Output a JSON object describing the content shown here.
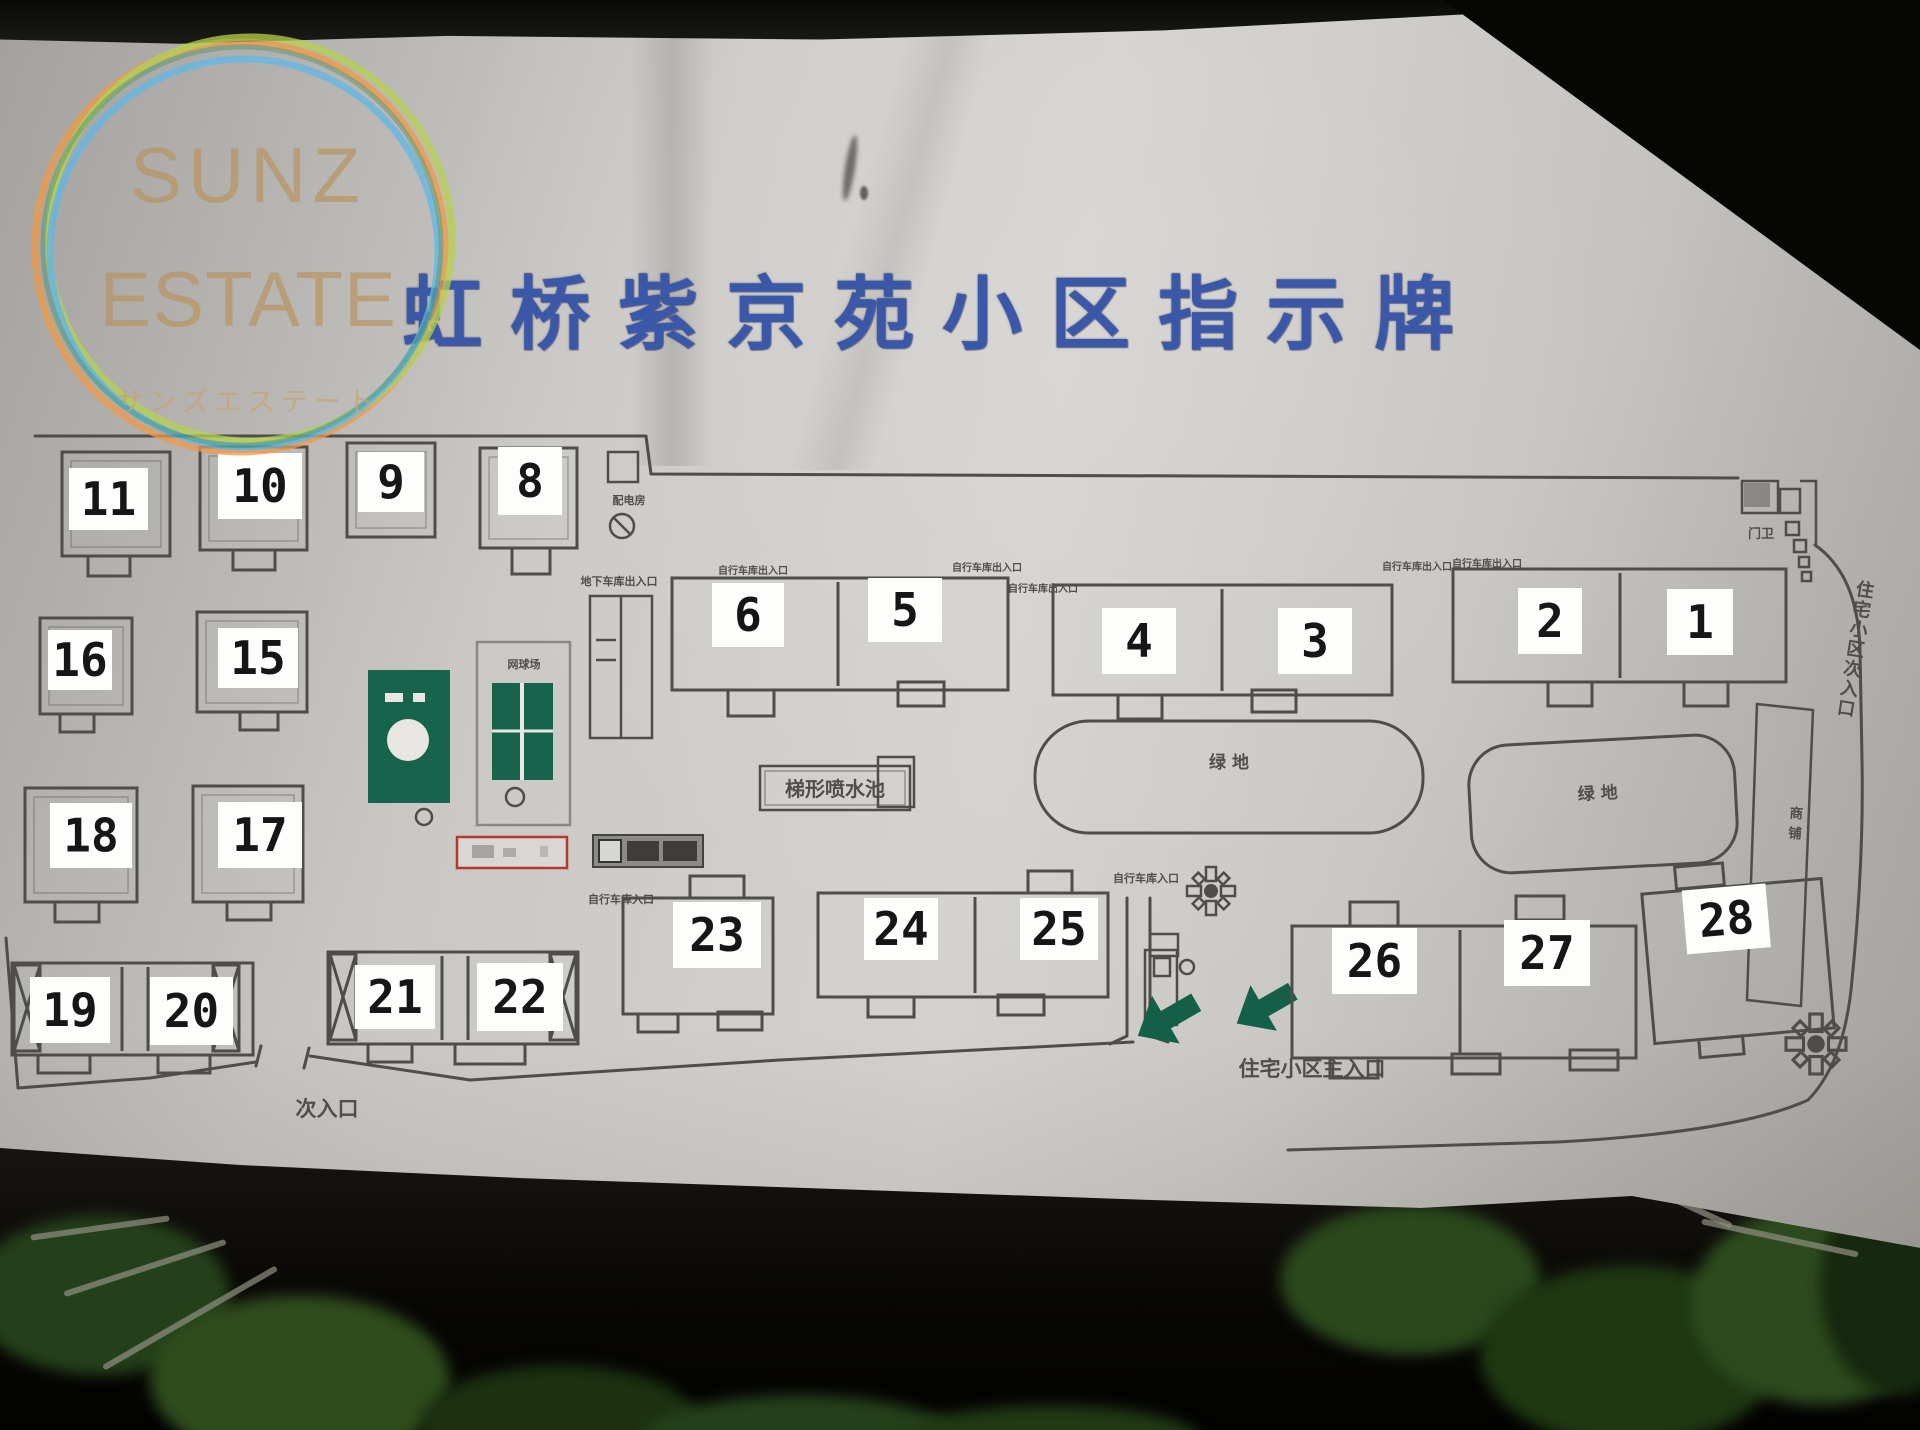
{
  "watermark": {
    "line1": "SUNZ",
    "line2": "ESTATE",
    "line3": "サンズエステート"
  },
  "sign_title": "虹桥紫京苑小区指示牌",
  "colors": {
    "title_blue": "#3a57a8",
    "map_line": "#4f4d49",
    "structure_green": "#17634b",
    "arrow_green": "#155e47",
    "you_are_here_red": "#b23b2d",
    "watermark_tan": "#b99562",
    "ring_orange": "#f09a46",
    "ring_lime": "#b6d24c",
    "ring_blue": "#5fb7e6"
  },
  "map": {
    "side_text": "住宅小区次入口",
    "shop_text": "商铺",
    "buildings": [
      {
        "n": "11",
        "o": [
          62,
          452,
          108,
          104
        ],
        "l": [
          69,
          468,
          79,
          62
        ],
        "s": [
          [
            88,
            556,
            42,
            20
          ]
        ],
        "inner": true
      },
      {
        "n": "10",
        "o": [
          200,
          447,
          107,
          103
        ],
        "l": [
          218,
          453,
          84,
          66
        ],
        "s": [
          [
            233,
            550,
            42,
            20
          ]
        ],
        "inner": true
      },
      {
        "n": "9",
        "o": [
          347,
          443,
          88,
          94
        ],
        "l": [
          358,
          452,
          66,
          60
        ],
        "inner": true
      },
      {
        "n": "8",
        "o": [
          480,
          448,
          97,
          100
        ],
        "l": [
          498,
          447,
          64,
          68
        ],
        "s": [
          [
            512,
            548,
            38,
            26
          ]
        ],
        "inner": true
      },
      {
        "n": "16",
        "o": [
          40,
          618,
          92,
          96
        ],
        "l": [
          48,
          630,
          64,
          60
        ],
        "s": [
          [
            60,
            714,
            34,
            18
          ]
        ],
        "inner": true
      },
      {
        "n": "15",
        "o": [
          197,
          612,
          110,
          100
        ],
        "l": [
          218,
          628,
          80,
          60
        ],
        "s": [
          [
            240,
            712,
            38,
            18
          ]
        ],
        "inner": true
      },
      {
        "n": "18",
        "o": [
          25,
          788,
          112,
          114
        ],
        "l": [
          50,
          803,
          82,
          65
        ],
        "s": [
          [
            55,
            902,
            44,
            20
          ]
        ],
        "inner": true
      },
      {
        "n": "17",
        "o": [
          193,
          786,
          110,
          116
        ],
        "l": [
          218,
          802,
          84,
          66
        ],
        "s": [
          [
            227,
            902,
            44,
            18
          ]
        ],
        "inner": true
      },
      {
        "n": "19",
        "o": [
          12,
          963,
          241,
          92
        ],
        "l": [
          30,
          977,
          80,
          66
        ],
        "s": [
          [
            38,
            1055,
            52,
            18
          ],
          [
            158,
            1055,
            52,
            18
          ]
        ],
        "d": [
          122,
          148
        ],
        "hatch": [
          [
            14,
            965,
            26,
            86
          ],
          [
            213,
            965,
            26,
            86
          ]
        ]
      },
      {
        "n": "20",
        "o": null,
        "l": [
          150,
          977,
          83,
          68
        ]
      },
      {
        "n": "21",
        "o": [
          328,
          952,
          250,
          92
        ],
        "l": [
          355,
          965,
          80,
          64
        ],
        "s": [
          [
            368,
            1044,
            44,
            18
          ],
          [
            455,
            1044,
            70,
            20
          ]
        ],
        "d": [
          442,
          468
        ],
        "hatch": [
          [
            330,
            954,
            26,
            86
          ],
          [
            550,
            954,
            26,
            86
          ]
        ]
      },
      {
        "n": "22",
        "o": null,
        "l": [
          477,
          963,
          86,
          68
        ]
      },
      {
        "n": "6",
        "o": [
          672,
          578,
          336,
          112
        ],
        "l": [
          712,
          583,
          72,
          64
        ],
        "s": [
          [
            728,
            690,
            46,
            26
          ],
          [
            898,
            682,
            46,
            24
          ]
        ],
        "d": [
          838
        ]
      },
      {
        "n": "5",
        "o": null,
        "l": [
          868,
          578,
          74,
          64
        ]
      },
      {
        "n": "4",
        "o": [
          1053,
          585,
          339,
          110
        ],
        "l": [
          1102,
          608,
          74,
          66
        ],
        "s": [
          [
            1118,
            695,
            44,
            24
          ],
          [
            1252,
            690,
            44,
            22
          ]
        ],
        "d": [
          1222
        ]
      },
      {
        "n": "3",
        "o": null,
        "l": [
          1278,
          608,
          74,
          66
        ]
      },
      {
        "n": "2",
        "o": [
          1453,
          569,
          333,
          113
        ],
        "l": [
          1518,
          588,
          64,
          66
        ],
        "s": [
          [
            1548,
            682,
            44,
            24
          ],
          [
            1684,
            682,
            44,
            24
          ]
        ],
        "d": [
          1620
        ]
      },
      {
        "n": "1",
        "o": null,
        "l": [
          1667,
          589,
          66,
          66
        ]
      },
      {
        "n": "23",
        "o": [
          623,
          898,
          150,
          116
        ],
        "l": [
          673,
          902,
          88,
          66
        ],
        "s": [
          [
            690,
            876,
            54,
            22
          ],
          [
            638,
            1014,
            40,
            18
          ],
          [
            718,
            1012,
            44,
            18
          ]
        ]
      },
      {
        "n": "24",
        "o": [
          818,
          893,
          290,
          104
        ],
        "l": [
          864,
          898,
          74,
          62
        ],
        "s": [
          [
            1028,
            871,
            44,
            22
          ],
          [
            868,
            997,
            46,
            20
          ],
          [
            998,
            995,
            46,
            20
          ]
        ],
        "d": [
          975
        ]
      },
      {
        "n": "25",
        "o": null,
        "l": [
          1020,
          898,
          78,
          62
        ]
      },
      {
        "n": "26",
        "o": [
          1292,
          926,
          344,
          132
        ],
        "l": [
          1332,
          928,
          85,
          66
        ],
        "s": [
          [
            1350,
            902,
            48,
            24
          ],
          [
            1516,
            896,
            48,
            24
          ],
          [
            1330,
            1058,
            48,
            20
          ],
          [
            1452,
            1054,
            48,
            20
          ],
          [
            1570,
            1050,
            48,
            20
          ]
        ],
        "d": [
          1460
        ]
      },
      {
        "n": "27",
        "o": null,
        "l": [
          1504,
          920,
          86,
          66
        ]
      },
      {
        "n": "28",
        "o": [
          1648,
          886,
          180,
          150
        ],
        "l": [
          1688,
          886,
          84,
          64
        ],
        "s": [
          [
            1683,
            862,
            48,
            22
          ],
          [
            1692,
            1036,
            44,
            18
          ]
        ],
        "r": -5
      }
    ],
    "labels": [
      {
        "t": "配电房",
        "x": 629,
        "y": 504,
        "s": 11
      },
      {
        "t": "地下车库出入口",
        "x": 619,
        "y": 585,
        "s": 11
      },
      {
        "t": "自行车库出入口",
        "x": 753,
        "y": 574,
        "s": 10
      },
      {
        "t": "自行车库出入口",
        "x": 987,
        "y": 571,
        "s": 10
      },
      {
        "t": "自行车库出入口",
        "x": 1043,
        "y": 592,
        "s": 10
      },
      {
        "t": "自行车库出入口",
        "x": 1417,
        "y": 570,
        "s": 10
      },
      {
        "t": "自行车库出入口",
        "x": 1487,
        "y": 567,
        "s": 10
      },
      {
        "t": "自行车库入口",
        "x": 621,
        "y": 903,
        "s": 11
      },
      {
        "t": "自行车库入口",
        "x": 1146,
        "y": 882,
        "s": 11
      },
      {
        "t": "门卫",
        "x": 1761,
        "y": 538,
        "s": 13
      },
      {
        "t": "绿  地",
        "x": 1229,
        "y": 768,
        "s": 17
      },
      {
        "t": "绿  地",
        "x": 1598,
        "y": 799,
        "s": 17,
        "r": -3
      },
      {
        "t": "网球场",
        "x": 524,
        "y": 668,
        "s": 11
      },
      {
        "t": "梯形喷水池",
        "x": 835,
        "y": 796,
        "s": 20,
        "box": [
          760,
          766,
          150,
          44
        ]
      },
      {
        "t": "次入口",
        "x": 327,
        "y": 1116,
        "s": 21
      },
      {
        "t": "住宅小区主入口",
        "x": 1312,
        "y": 1076,
        "s": 21
      }
    ]
  }
}
